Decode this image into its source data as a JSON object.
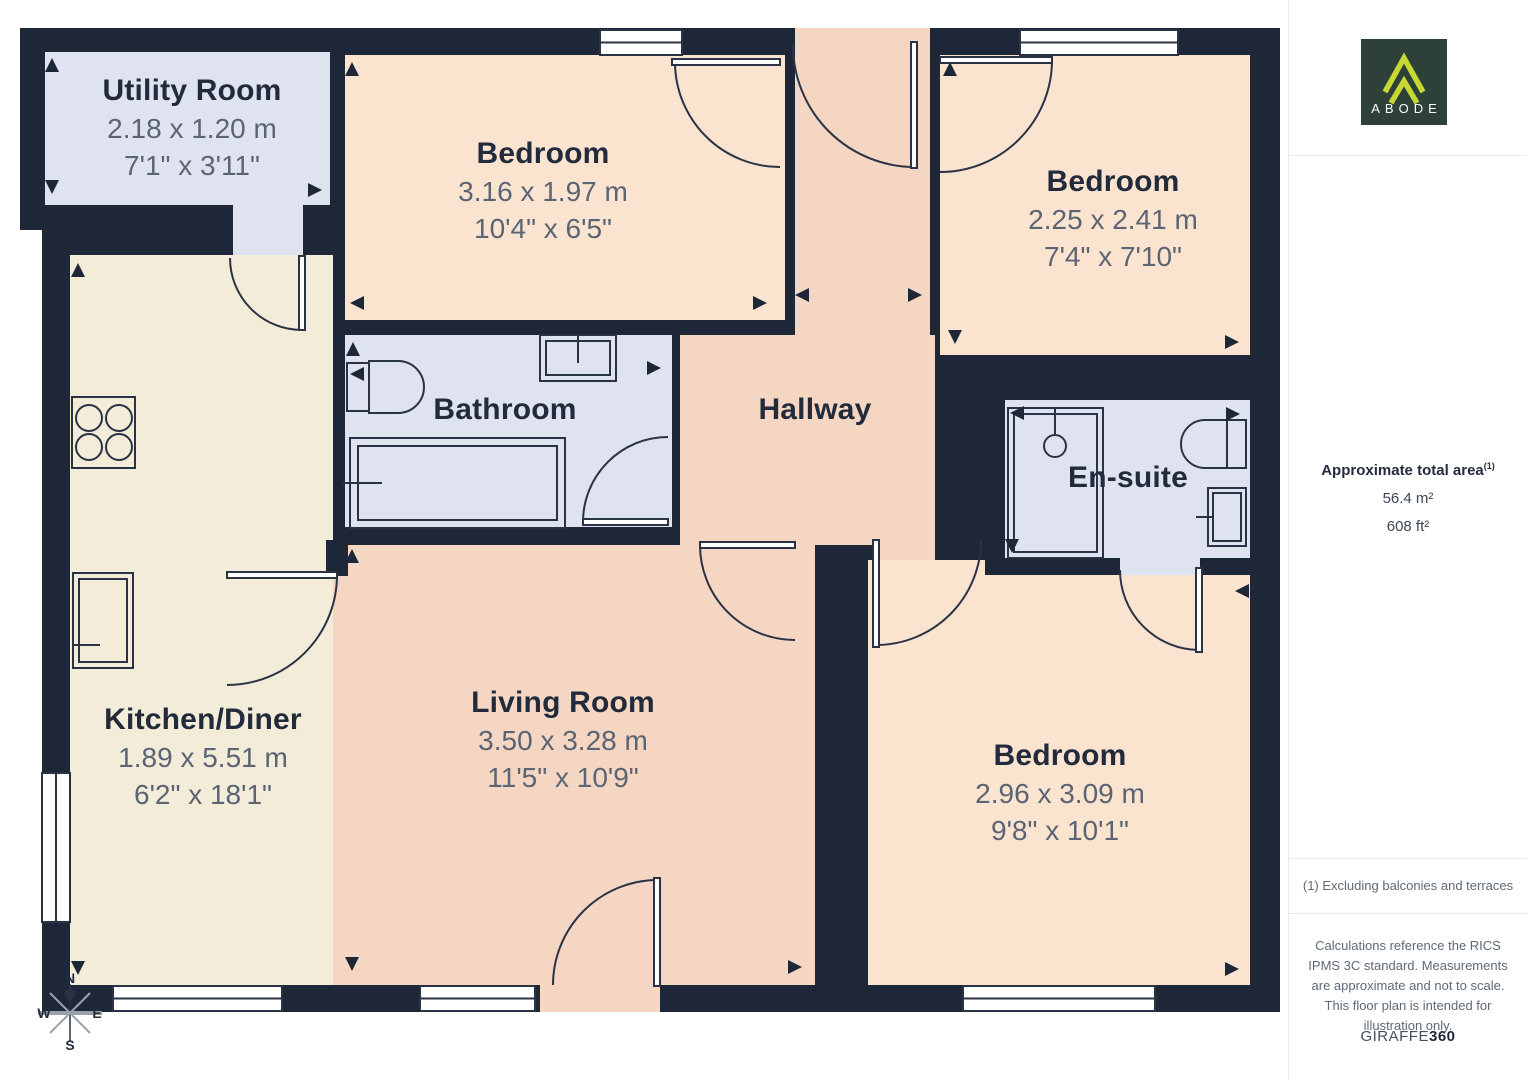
{
  "plan": {
    "rooms": [
      {
        "id": "utility",
        "name": "Utility Room",
        "dim_m": "2.18 x 1.20 m",
        "dim_ft": "7'1\" x 3'11\""
      },
      {
        "id": "bedroom_top",
        "name": "Bedroom",
        "dim_m": "3.16 x 1.97 m",
        "dim_ft": "10'4\" x 6'5\""
      },
      {
        "id": "bedroom_right",
        "name": "Bedroom",
        "dim_m": "2.25 x 2.41 m",
        "dim_ft": "7'4\" x 7'10\""
      },
      {
        "id": "bathroom",
        "name": "Bathroom"
      },
      {
        "id": "hallway",
        "name": "Hallway"
      },
      {
        "id": "ensuite",
        "name": "En-suite"
      },
      {
        "id": "kitchen",
        "name": "Kitchen/Diner",
        "dim_m": "1.89 x 5.51 m",
        "dim_ft": "6'2\" x 18'1\""
      },
      {
        "id": "living",
        "name": "Living Room",
        "dim_m": "3.50 x 3.28 m",
        "dim_ft": "11'5\" x 10'9\""
      },
      {
        "id": "bedroom_bottom",
        "name": "Bedroom",
        "dim_m": "2.96 x 3.09 m",
        "dim_ft": "9'8\" x 10'1\""
      }
    ],
    "compass": {
      "n": "N",
      "e": "E",
      "s": "S",
      "w": "W"
    }
  },
  "sidebar": {
    "logo": {
      "brand": "ABODE"
    },
    "area": {
      "title": "Approximate total area",
      "superscript": "(1)",
      "metric": "56.4 m²",
      "imperial": "608 ft²"
    },
    "footnote": "(1) Excluding balconies and terraces",
    "disclaimer": "Calculations reference the RICS IPMS 3C standard. Measurements are approximate and not to scale. This floor plan is intended for illustration only.",
    "provider": {
      "name": "GIRAFFE",
      "suffix": "360"
    }
  },
  "colors": {
    "wall": "#1e2738",
    "bedroom_floor": "#fbe4cf",
    "hallway_floor": "#f4d6c2",
    "wet_room_floor": "#dfe3ef",
    "kitchen_floor": "#f2ecd8",
    "line": "#2a3345",
    "logo_bg": "#2e4138",
    "logo_accent": "#c6d831"
  }
}
